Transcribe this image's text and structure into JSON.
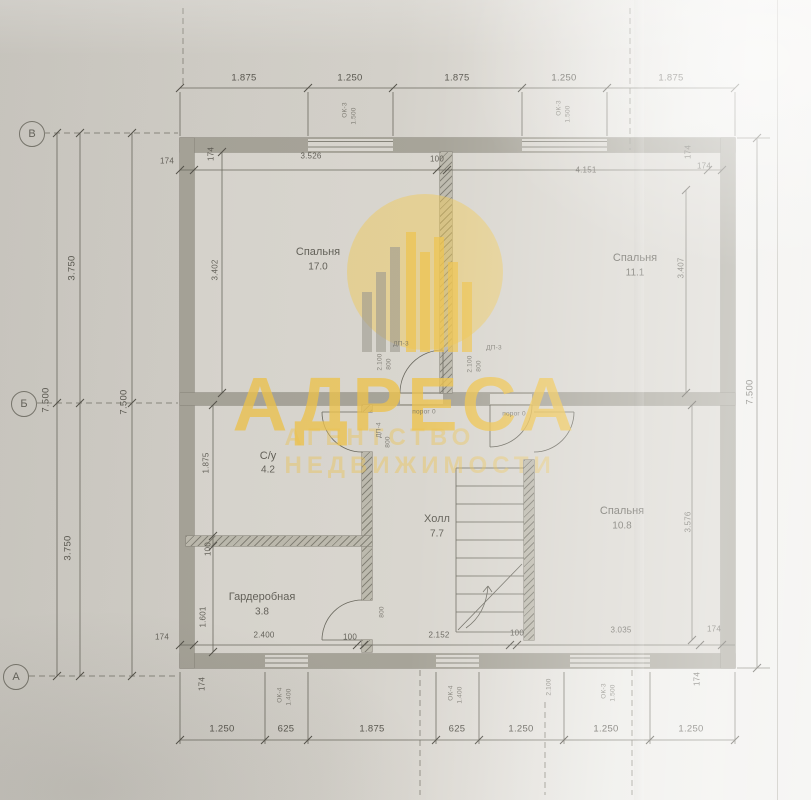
{
  "watermark": {
    "title": "АДРЕСА",
    "subtitle": "АГЕНТСТВО НЕДВИЖИМОСТИ"
  },
  "axes": [
    {
      "label": "В"
    },
    {
      "label": "Б"
    },
    {
      "label": "А"
    }
  ],
  "rooms": [
    {
      "name": "Спальня",
      "area": "17.0"
    },
    {
      "name": "Спальня",
      "area": "11.1"
    },
    {
      "name": "С/у",
      "area": "4.2"
    },
    {
      "name": "Холл",
      "area": "7.7"
    },
    {
      "name": "Гардеробная",
      "area": "3.8"
    },
    {
      "name": "Спальня",
      "area": "10.8"
    }
  ],
  "dims": {
    "top": [
      "1.875",
      "1.250",
      "1.875",
      "1.250",
      "1.875"
    ],
    "bottom": [
      "1.250",
      "625",
      "1.875",
      "625",
      "1.250",
      "1.250",
      "1.250"
    ],
    "left": [
      "7.500",
      "3.750",
      "3.750",
      "7.500"
    ],
    "right": [
      "7.500"
    ],
    "inner": [
      "174",
      "3.526",
      "100",
      "4.151",
      "174",
      "3.402",
      "3.407",
      "1.875",
      "100",
      "1.601",
      "3.576",
      "174",
      "174",
      "174",
      "2.400",
      "100",
      "2.152",
      "100",
      "3.035",
      "174",
      "174",
      "174"
    ],
    "marks": [
      "ОК-3",
      "1.500",
      "ОК-3",
      "1.500",
      "ОК-4",
      "1.400",
      "ОК-4",
      "1.400",
      "ОК-3",
      "1.500",
      "ДП-3",
      "ДП-3",
      "2.100",
      "800",
      "2.100",
      "800",
      "порог 0",
      "порог 0",
      "ДП-4",
      "800",
      "800",
      "2.100"
    ]
  },
  "colors": {
    "accent": "#eec34d",
    "paper": "#d2cfc8",
    "wall": "#a7a499",
    "line": "#6b695f"
  }
}
